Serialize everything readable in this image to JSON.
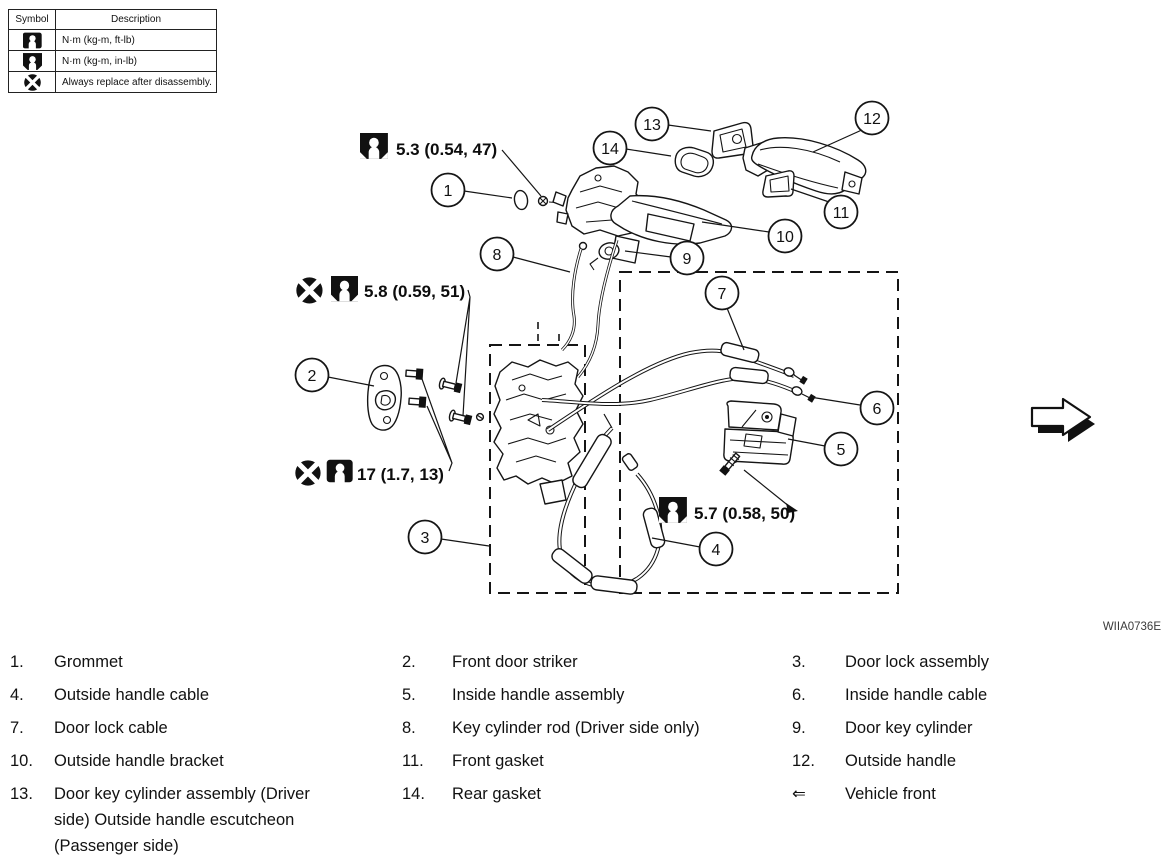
{
  "figure": {
    "code": "WIIA0736E"
  },
  "symbol_table": {
    "headers": [
      "Symbol",
      "Description"
    ],
    "rows": [
      {
        "icon": "torque-ftlb-icon",
        "description": "N·m (kg-m, ft-lb)"
      },
      {
        "icon": "torque-inlb-icon",
        "description": "N·m (kg-m, in-lb)"
      },
      {
        "icon": "replace-icon",
        "description": "Always replace after disassembly."
      }
    ]
  },
  "diagram": {
    "callouts": [
      {
        "num": "1"
      },
      {
        "num": "2"
      },
      {
        "num": "3"
      },
      {
        "num": "4"
      },
      {
        "num": "5"
      },
      {
        "num": "6"
      },
      {
        "num": "7"
      },
      {
        "num": "8"
      },
      {
        "num": "9"
      },
      {
        "num": "10"
      },
      {
        "num": "11"
      },
      {
        "num": "12"
      },
      {
        "num": "13"
      },
      {
        "num": "14"
      }
    ],
    "torque_specs": [
      {
        "value": "5.3 (0.54, 47)",
        "icons": [
          "torque-inlb-icon"
        ]
      },
      {
        "value": "5.8 (0.59, 51)",
        "icons": [
          "replace-icon",
          "torque-inlb-icon"
        ]
      },
      {
        "value": "17 (1.7, 13)",
        "icons": [
          "replace-icon",
          "torque-ftlb-icon"
        ]
      },
      {
        "value": "5.7 (0.58, 50)",
        "icons": [
          "torque-inlb-icon"
        ]
      }
    ],
    "direction_arrow": "vehicle-front"
  },
  "legend": {
    "items": [
      {
        "num": "1.",
        "label": "Grommet"
      },
      {
        "num": "2.",
        "label": "Front door striker"
      },
      {
        "num": "3.",
        "label": "Door lock assembly"
      },
      {
        "num": "4.",
        "label": "Outside handle cable"
      },
      {
        "num": "5.",
        "label": "Inside handle assembly"
      },
      {
        "num": "6.",
        "label": "Inside handle cable"
      },
      {
        "num": "7.",
        "label": "Door lock cable"
      },
      {
        "num": "8.",
        "label": "Key cylinder rod (Driver side only)"
      },
      {
        "num": "9.",
        "label": "Door key cylinder"
      },
      {
        "num": "10.",
        "label": "Outside handle bracket"
      },
      {
        "num": "11.",
        "label": "Front gasket"
      },
      {
        "num": "12.",
        "label": "Outside handle"
      },
      {
        "num": "13.",
        "label": "Door key cylinder assembly (Driver side) Outside handle escutcheon (Passenger side)"
      },
      {
        "num": "14.",
        "label": "Rear gasket"
      },
      {
        "num": "⇐",
        "label": "Vehicle front"
      }
    ]
  }
}
